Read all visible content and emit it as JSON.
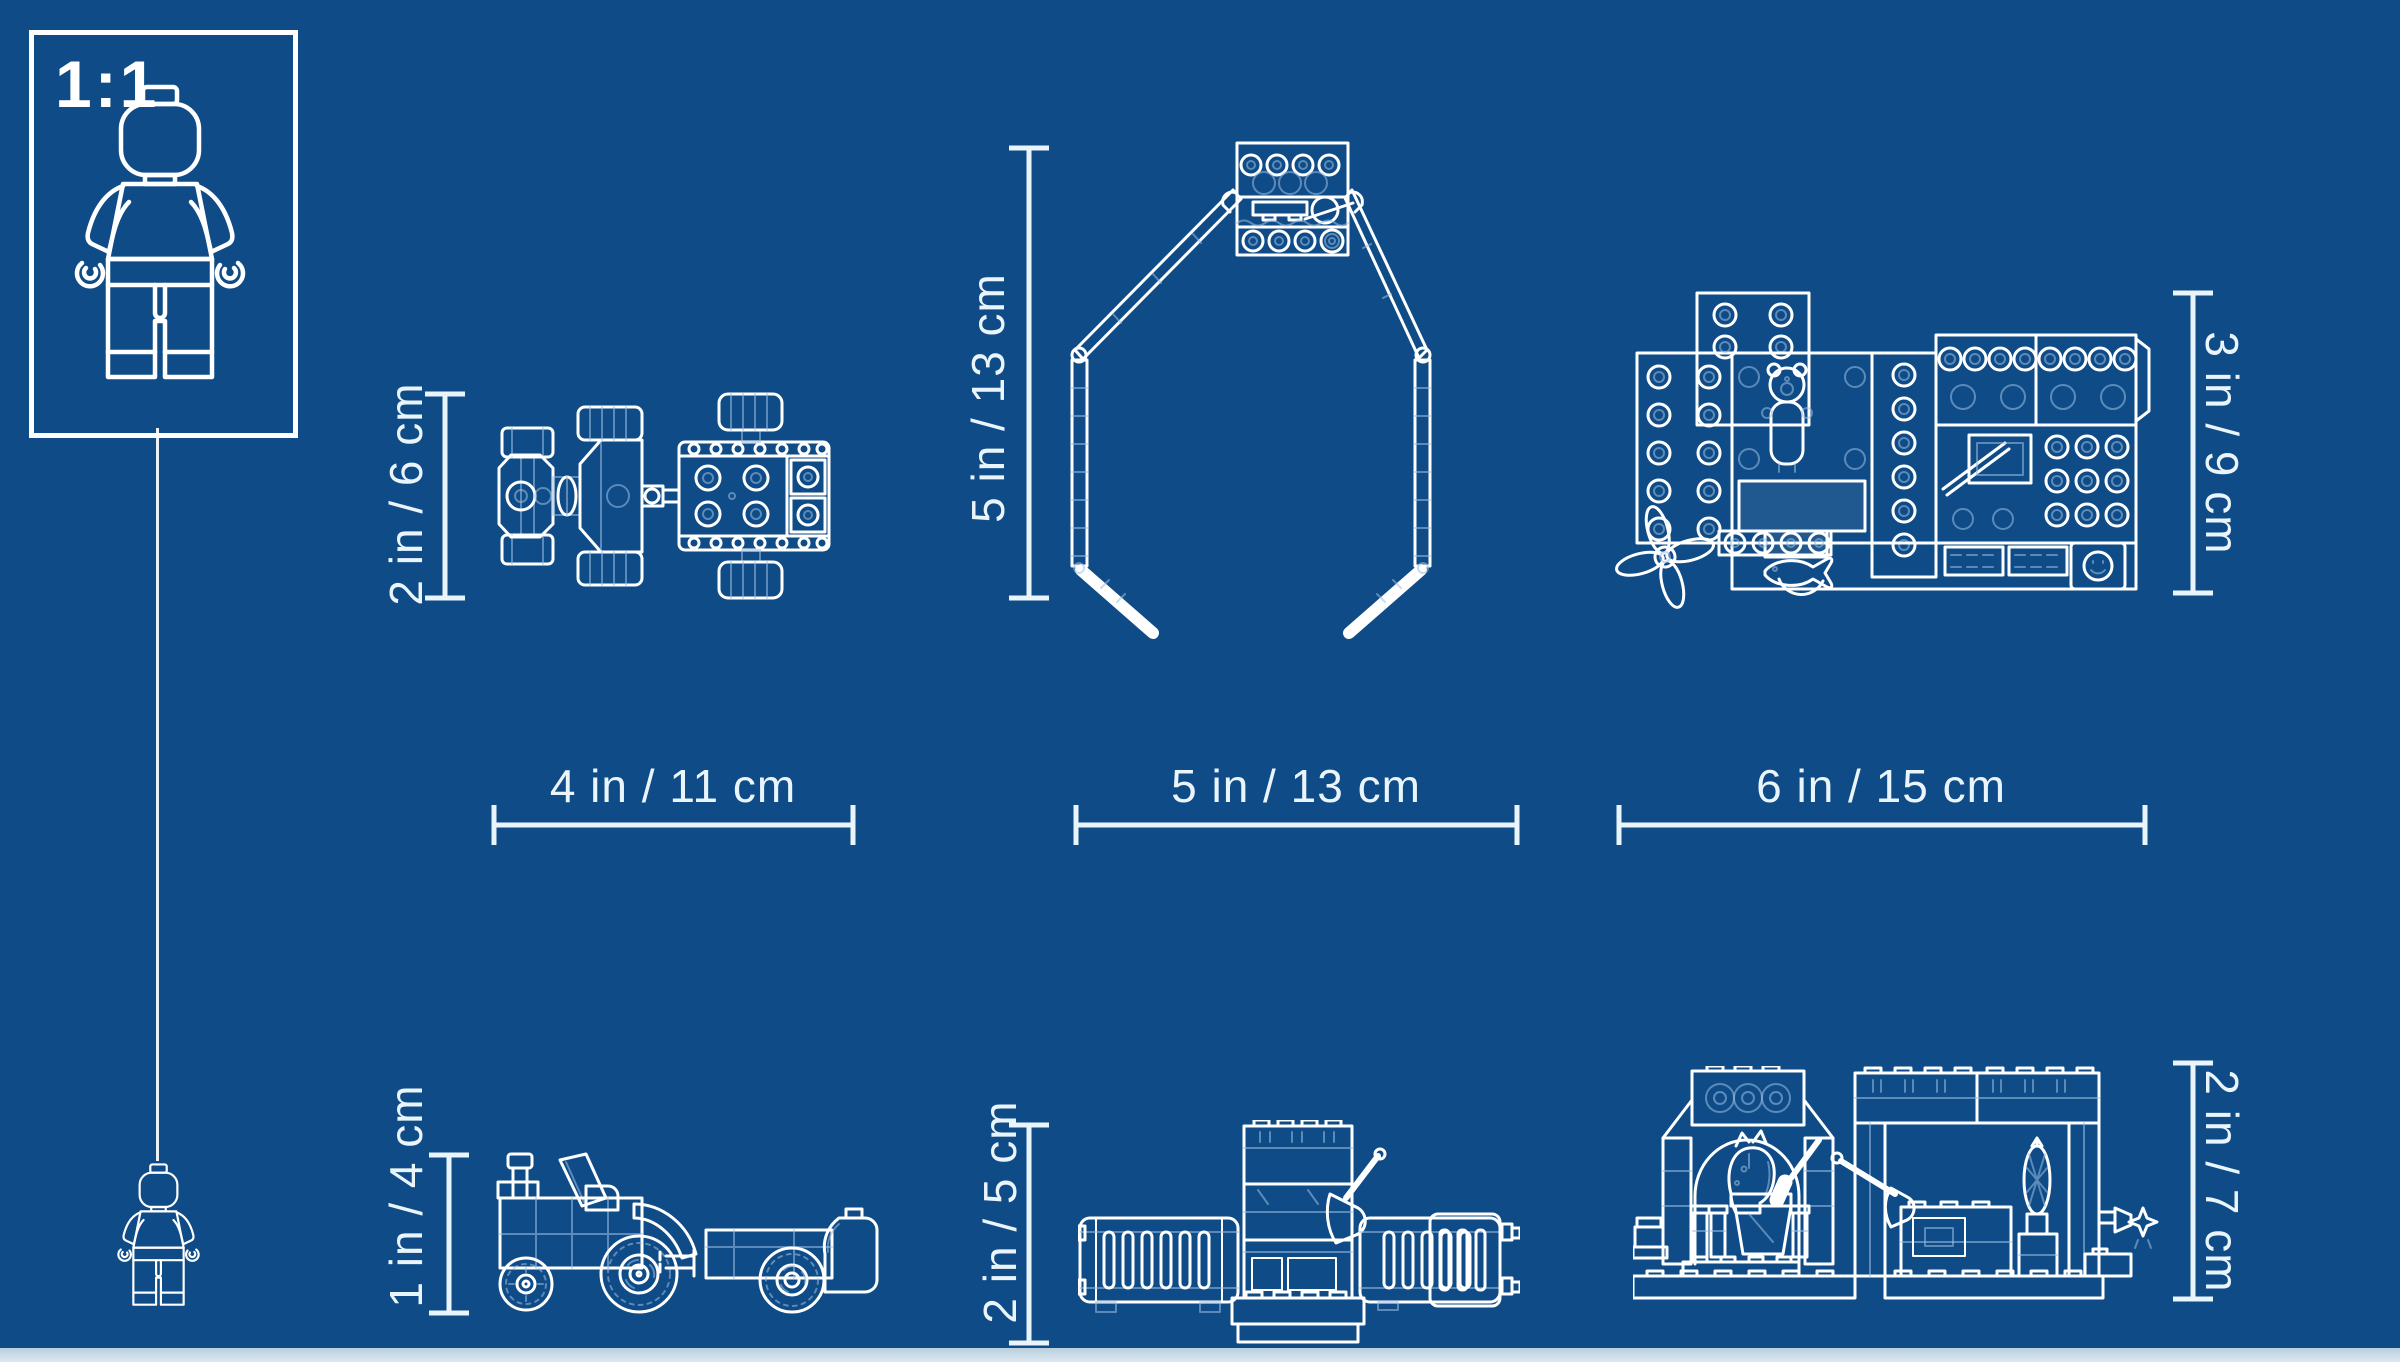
{
  "colors": {
    "background": "#0e4b87",
    "line": "#ffffff",
    "faint": "#9cc0e2",
    "dimension": "#eaf4fb",
    "footer_strip": "#dce9f1"
  },
  "scale_box": {
    "label": "1:1"
  },
  "dimensions": {
    "tractor_top": {
      "width": "4 in / 11 cm",
      "height": "2 in / 6 cm"
    },
    "octagon_frame": {
      "width": "5 in / 13 cm",
      "height": "5 in / 13 cm"
    },
    "baseplate": {
      "width": "6 in / 15 cm",
      "height": "3 in / 9 cm"
    },
    "tractor_side": {
      "height": "1 in / 4 cm"
    },
    "fence": {
      "height": "2 in / 5 cm"
    },
    "stable": {
      "height": "2 in / 7 cm"
    }
  }
}
